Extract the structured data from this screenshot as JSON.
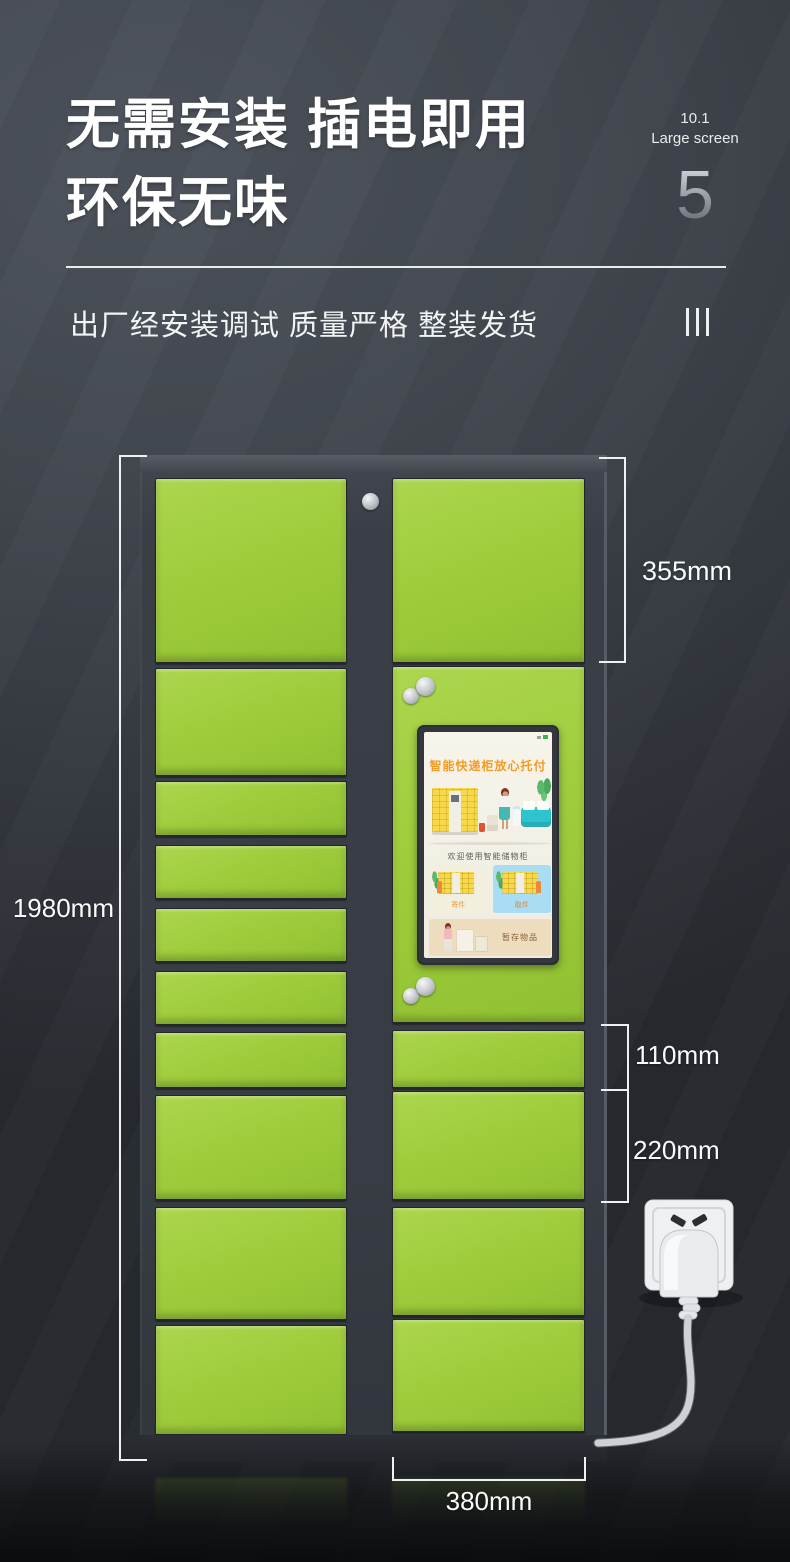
{
  "header": {
    "title_line1": "无需安装 插电即用",
    "title_line2": "环保无味",
    "screen_size": "10.1",
    "screen_size_label": "Large screen",
    "page_number": "5",
    "subtitle": "出厂经安装调试 质量严格 整装发货"
  },
  "dimensions": {
    "cabinet_height": "1980mm",
    "top_door": "355mm",
    "small_door": "110mm",
    "medium_door": "220mm",
    "column_width": "380mm"
  },
  "locker_screen": {
    "headline": "智能快递柜放心托付",
    "welcome_text": "欢迎使用智能储物柜",
    "card_send_label": "寄件",
    "card_pickup_label": "取件",
    "card_storage_label": "暂存物品"
  },
  "cabinet": {
    "left_door_count": 10,
    "right_door_count": 6
  },
  "colors": {
    "door_green": "#9fcc3c",
    "frame_dark": "#3a3e46",
    "accent_orange": "#f59b25",
    "annotation_white": "#fafbfc",
    "screen_card_blue": "#a9ddf3",
    "screen_card_tan": "#eedcbf"
  },
  "icons": {
    "lock": "lock-icon",
    "door_knobs": "knob-icon",
    "power_socket": "power-socket-icon",
    "power_plug": "power-plug-icon",
    "section_marker": "triple-bar-icon"
  }
}
